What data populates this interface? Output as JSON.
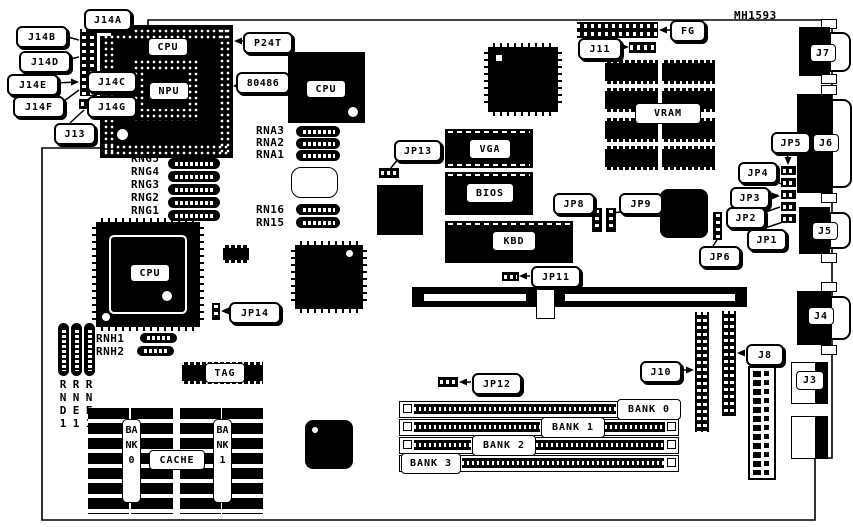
{
  "title": "MH1593",
  "callouts": {
    "j14a": "J14A",
    "j14b": "J14B",
    "j14c": "J14C",
    "j14d": "J14D",
    "j14e": "J14E",
    "j14f": "J14F",
    "j14g": "J14G",
    "j13": "J13",
    "p24t": "P24T",
    "i486": "80486",
    "jp13": "JP13",
    "fg": "FG",
    "j11": "J11",
    "jp8": "JP8",
    "jp9": "JP9",
    "jp6": "JP6",
    "jp5": "JP5",
    "jp4": "JP4",
    "jp3": "JP3",
    "jp2": "JP2",
    "jp1": "JP1",
    "jp14": "JP14",
    "jp11": "JP11",
    "jp12": "JP12",
    "j10": "J10",
    "j8": "J8"
  },
  "connectors": {
    "j7": "J7",
    "j6": "J6",
    "j5": "J5",
    "j4": "J4",
    "j3": "J3"
  },
  "ics": {
    "cpu": "CPU",
    "npu": "NPU",
    "vga": "VGA",
    "bios": "BIOS",
    "kbd": "KBD",
    "vram": "VRAM",
    "tag": "TAG",
    "cache": "CACHE"
  },
  "memory": {
    "bank0": "BANK 0",
    "bank1": "BANK 1",
    "bank2": "BANK 2",
    "bank3": "BANK 3",
    "cache_bank0": "BANK0",
    "cache_bank1": "BANK1"
  },
  "resnets": {
    "rng5": "RNG5",
    "rng4": "RNG4",
    "rng3": "RNG3",
    "rng2": "RNG2",
    "rng1": "RNG1",
    "rna3": "RNA3",
    "rna2": "RNA2",
    "rna1": "RNA1",
    "rn16": "RN16",
    "rn15": "RN15",
    "rnh1": "RNH1",
    "rnh2": "RNH2",
    "rnd1": "RND1",
    "rne1": "RNE1",
    "rnf1": "RNF1"
  }
}
